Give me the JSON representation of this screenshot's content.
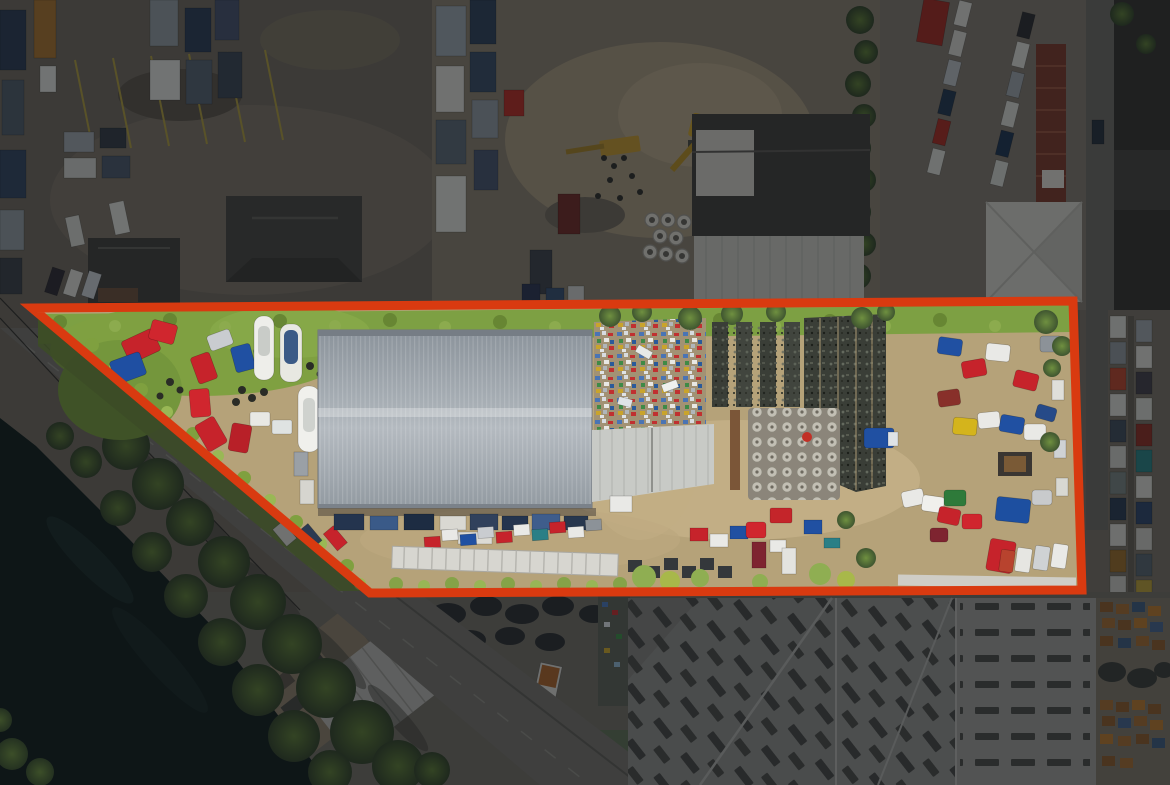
{
  "image": {
    "description": "Aerial drone photograph of a commercial truck salvage yard. A wedge-shaped parcel is outlined with a thick red boundary; the parcel interior is shown at full brightness while everything outside the boundary is darkened. Inside the parcel: a large gray metal warehouse, rows of colorful semi-truck cabs (red, blue, white, yellow), boats, stacked engine parts and wheel pallets on tan dirt with green overgrowth. Outside: neighboring truck yards, dark-roofed buildings, parked cars, a vertical access road, a diagonal tree-lined road, a dark canal at lower left, and large light-gray warehouse roofs with skylights at lower right.",
    "width_px": 1170,
    "height_px": 785,
    "visible_text": []
  },
  "palette": {
    "boundary_red": "#d93a10",
    "dim_shade": "#0a0d12",
    "water": "#121e1c",
    "road_gray": "#74716a",
    "asphalt": "#6e675d",
    "dirt_outside": "#867c6c",
    "dirt_inside": "#b5a279",
    "dirt_bright": "#c7b48a",
    "grass_green": "#7da043",
    "grass_deep": "#5d7c32",
    "tree_green": "#46572e",
    "warehouse_roof": "#9aa1a8",
    "annex_roof": "#c8cac6",
    "big_roof": "#8f8e8a",
    "skylight_dark": "#454540",
    "building_dark": "#403e3a",
    "white_roof": "#cfcdc5",
    "container_rust": "#78382a",
    "pallet_wood": "#96602e",
    "junk_dark": "#3a3e37",
    "cab_red": "#c6232b",
    "cab_blue": "#2050a2",
    "cab_white": "#e9e9e6",
    "cab_yellow": "#d4b41c"
  },
  "boundary": {
    "stroke_color": "#d93a10",
    "stroke_width": 9,
    "dim_color": "#0a0d12",
    "dim_opacity": 0.5,
    "points": [
      [
        32,
        308
      ],
      [
        1073,
        301
      ],
      [
        1082,
        590
      ],
      [
        370,
        593
      ]
    ]
  }
}
